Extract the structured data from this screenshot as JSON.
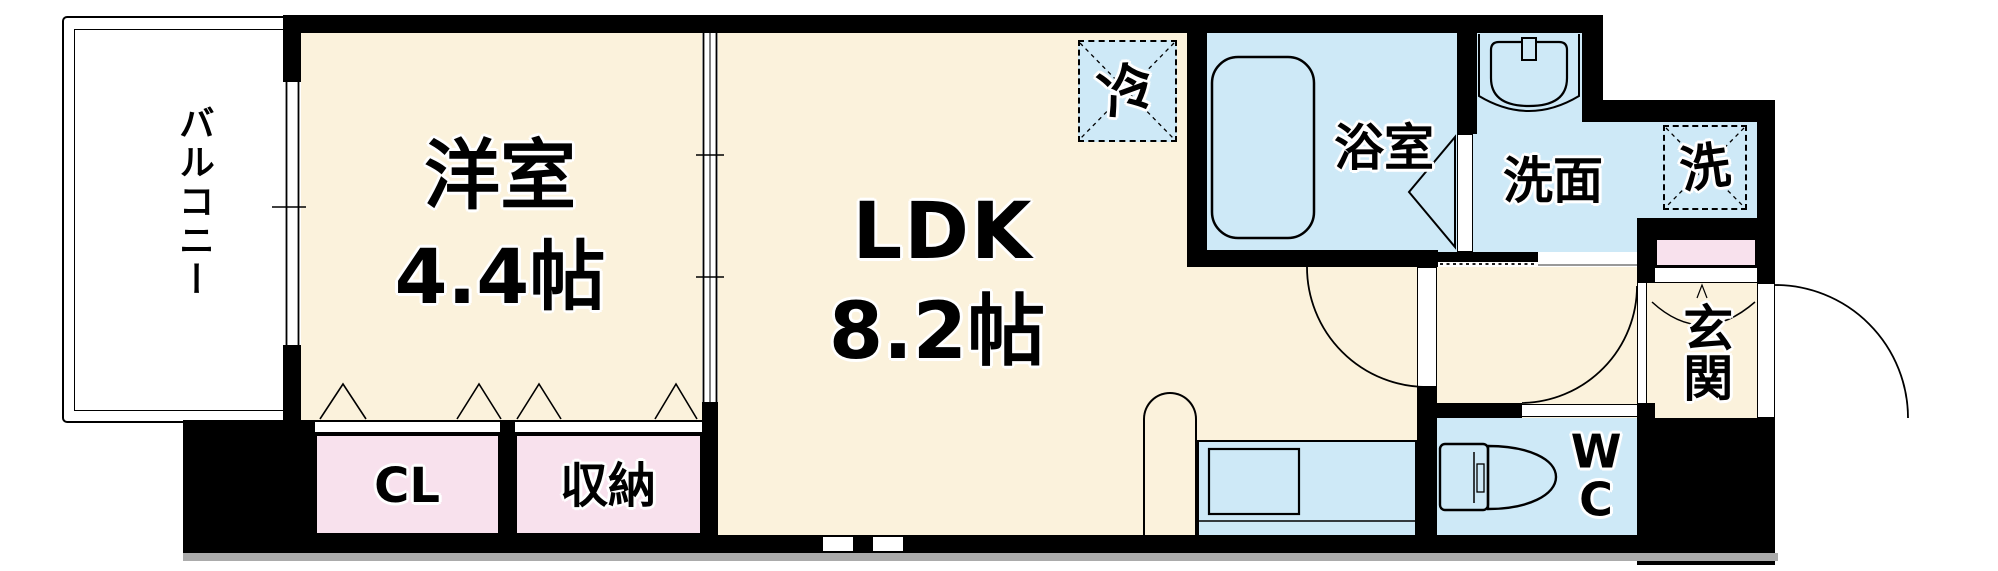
{
  "colors": {
    "floor_cream": "#FBF2DC",
    "wet_blue": "#CEE9F7",
    "closet_pink": "#F8E1ED",
    "wall": "#000000",
    "shadow_gray": "#ABABAB"
  },
  "rooms": {
    "balcony": {
      "label": "バルコニー"
    },
    "western_room": {
      "label": "洋室",
      "size": "4.4帖"
    },
    "ldk": {
      "label": "LDK",
      "size": "8.2帖"
    },
    "bathroom": {
      "label": "浴室"
    },
    "washroom": {
      "label": "洗面"
    },
    "entrance": {
      "label": "玄関"
    },
    "wc": {
      "label": "WC"
    },
    "closet": {
      "label": "CL"
    },
    "storage": {
      "label": "収納"
    }
  },
  "fixtures": {
    "refrigerator_space": {
      "label": "冷"
    },
    "washer_space": {
      "label": "洗"
    }
  }
}
